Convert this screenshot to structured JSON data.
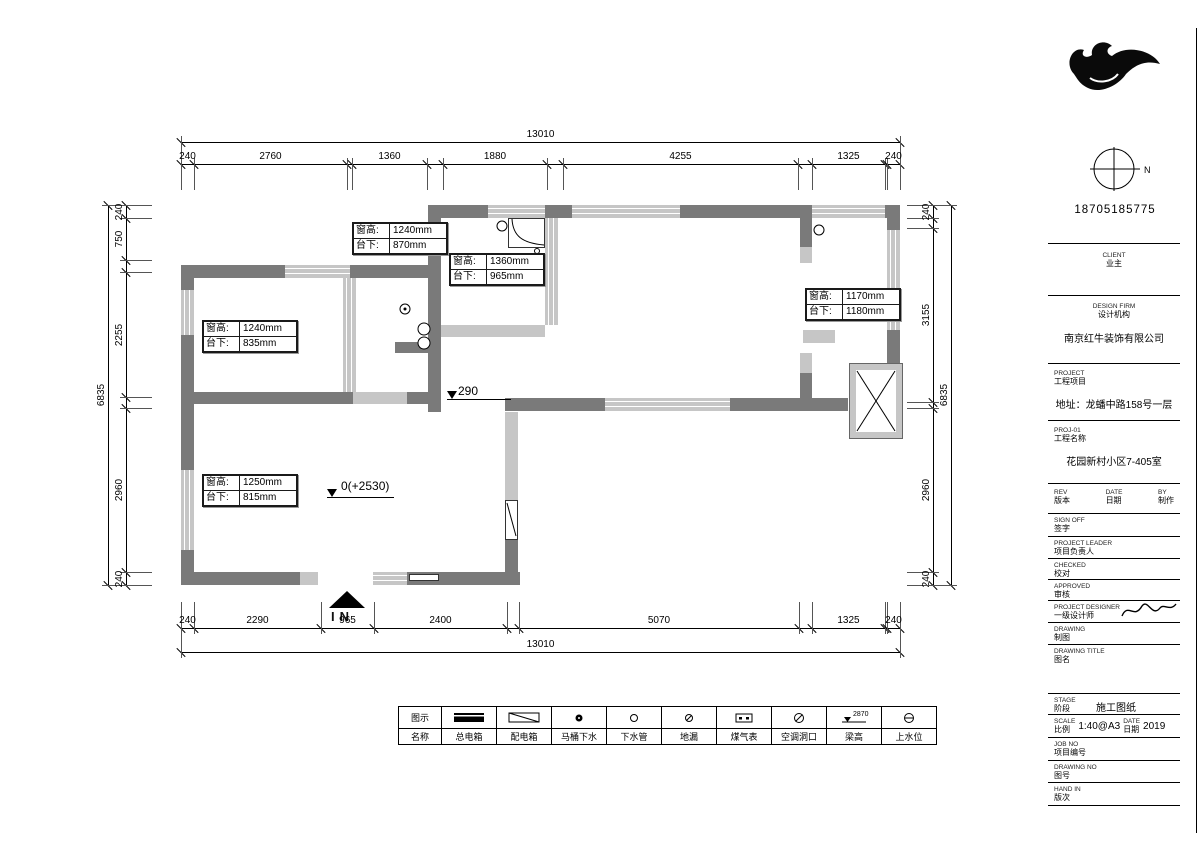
{
  "title_block": {
    "logo_text": "红牛装饰",
    "compass_label": "N",
    "phone": "18705185775",
    "rows": [
      {
        "y": 243,
        "type": "rule"
      },
      {
        "y": 252,
        "type": "center2",
        "en": "CLIENT",
        "zh": "业主"
      },
      {
        "y": 295,
        "type": "rule"
      },
      {
        "y": 303,
        "type": "center2",
        "en": "DESIGN FIRM",
        "zh": "设计机构"
      },
      {
        "y": 330,
        "type": "value",
        "text": "南京红牛装饰有限公司"
      },
      {
        "y": 363,
        "type": "rule"
      },
      {
        "y": 370,
        "type": "left2",
        "en": "PROJECT",
        "zh": "工程项目"
      },
      {
        "y": 396,
        "type": "value",
        "text": "地址：龙蟠中路158号一层"
      },
      {
        "y": 420,
        "type": "rule"
      },
      {
        "y": 427,
        "type": "left2",
        "en": "PROJ-01",
        "zh": "工程名称"
      },
      {
        "y": 453,
        "type": "value",
        "text": "花园新村小区7-405室"
      },
      {
        "y": 483,
        "type": "rule"
      },
      {
        "y": 489,
        "type": "cols3",
        "c1en": "REV",
        "c1zh": "版本",
        "c2en": "DATE",
        "c2zh": "日期",
        "c3en": "BY",
        "c3zh": "制作"
      },
      {
        "y": 513,
        "type": "rule"
      },
      {
        "y": 517,
        "type": "left2",
        "en": "SIGN OFF",
        "zh": "签字"
      },
      {
        "y": 536,
        "type": "rule"
      },
      {
        "y": 540,
        "type": "left2",
        "en": "PROJECT LEADER",
        "zh": "项目负责人"
      },
      {
        "y": 558,
        "type": "rule"
      },
      {
        "y": 562,
        "type": "left2",
        "en": "CHECKED",
        "zh": "校对"
      },
      {
        "y": 579,
        "type": "rule"
      },
      {
        "y": 583,
        "type": "left2",
        "en": "APPROVED",
        "zh": "审核"
      },
      {
        "y": 600,
        "type": "rule"
      },
      {
        "y": 604,
        "type": "left2sig",
        "en": "PROJECT DESIGNER",
        "zh": "一级设计师"
      },
      {
        "y": 622,
        "type": "rule"
      },
      {
        "y": 626,
        "type": "left2",
        "en": "DRAWING",
        "zh": "制图"
      },
      {
        "y": 644,
        "type": "rule"
      },
      {
        "y": 648,
        "type": "left2",
        "en": "DRAWING TITLE",
        "zh": "图名"
      },
      {
        "y": 693,
        "type": "rule"
      },
      {
        "y": 697,
        "type": "stage",
        "en": "STAGE",
        "zh": "阶段",
        "value": "施工图纸"
      },
      {
        "y": 714,
        "type": "rule"
      },
      {
        "y": 718,
        "type": "scaledate",
        "en1": "SCALE",
        "zh1": "比例",
        "v1": "1:40@A3",
        "en2": "DATE",
        "zh2": "日期",
        "v2": "2019"
      },
      {
        "y": 737,
        "type": "rule"
      },
      {
        "y": 741,
        "type": "left2",
        "en": "JOB NO",
        "zh": "项目编号"
      },
      {
        "y": 760,
        "type": "rule"
      },
      {
        "y": 764,
        "type": "left2",
        "en": "DRAWING NO",
        "zh": "图号"
      },
      {
        "y": 782,
        "type": "rule"
      },
      {
        "y": 786,
        "type": "left2",
        "en": "HAND IN",
        "zh": "版次"
      },
      {
        "y": 805,
        "type": "rule"
      }
    ]
  },
  "dimensions": {
    "chains": [
      {
        "id": "top-total",
        "orient": "h",
        "x": 181,
        "y": 142,
        "length": 719,
        "dir": "down",
        "segments": [
          {
            "from": 0,
            "to": 719,
            "label": "13010"
          }
        ]
      },
      {
        "id": "top-segments",
        "orient": "h",
        "x": 181,
        "y": 164,
        "length": 719,
        "dir": "down",
        "segments": [
          {
            "from": 0,
            "to": 13,
            "label": "240"
          },
          {
            "from": 13,
            "to": 166,
            "label": "2760"
          },
          {
            "from": 171,
            "to": 246,
            "label": "1360"
          },
          {
            "from": 262,
            "to": 366,
            "label": "1880"
          },
          {
            "from": 382,
            "to": 617,
            "label": "4255"
          },
          {
            "from": 631,
            "to": 704,
            "label": "1325"
          },
          {
            "from": 706,
            "to": 719,
            "label": "240"
          }
        ]
      },
      {
        "id": "bottom-segments",
        "orient": "h",
        "x": 181,
        "y": 628,
        "length": 719,
        "dir": "up",
        "segments": [
          {
            "from": 0,
            "to": 13,
            "label": "240"
          },
          {
            "from": 13,
            "to": 140,
            "label": "2290"
          },
          {
            "from": 140,
            "to": 193,
            "label": "965"
          },
          {
            "from": 193,
            "to": 326,
            "label": "2400"
          },
          {
            "from": 338,
            "to": 618,
            "label": "5070"
          },
          {
            "from": 631,
            "to": 704,
            "label": "1325"
          },
          {
            "from": 706,
            "to": 719,
            "label": "240"
          }
        ]
      },
      {
        "id": "bottom-total",
        "orient": "h",
        "x": 181,
        "y": 652,
        "length": 719,
        "dir": "up",
        "segments": [
          {
            "from": 0,
            "to": 719,
            "label": "13010"
          }
        ]
      },
      {
        "id": "left-total",
        "orient": "v",
        "x": 108,
        "y": 205,
        "length": 380,
        "dir": "right",
        "segments": [
          {
            "from": 0,
            "to": 380,
            "label": "6835"
          }
        ]
      },
      {
        "id": "left-segments",
        "orient": "v",
        "x": 126,
        "y": 205,
        "length": 380,
        "dir": "right",
        "segments": [
          {
            "from": 0,
            "to": 13,
            "label": "240"
          },
          {
            "from": 13,
            "to": 55,
            "label": "750"
          },
          {
            "from": 67,
            "to": 192,
            "label": "2255"
          },
          {
            "from": 203,
            "to": 367,
            "label": "2960"
          },
          {
            "from": 367,
            "to": 380,
            "label": "240"
          }
        ]
      },
      {
        "id": "right-segments",
        "orient": "v",
        "x": 933,
        "y": 205,
        "length": 380,
        "dir": "left",
        "segments": [
          {
            "from": 0,
            "to": 13,
            "label": "240"
          },
          {
            "from": 23,
            "to": 197,
            "label": "3155"
          },
          {
            "from": 203,
            "to": 367,
            "label": "2960"
          },
          {
            "from": 367,
            "to": 380,
            "label": "240"
          }
        ]
      },
      {
        "id": "right-total",
        "orient": "v",
        "x": 951,
        "y": 205,
        "length": 380,
        "dir": "left",
        "segments": [
          {
            "from": 0,
            "to": 380,
            "label": "6835"
          }
        ]
      }
    ]
  },
  "plan": {
    "window_labels": [
      {
        "x": 352,
        "y": 222,
        "rows": [
          [
            "窗高:",
            "1240mm"
          ],
          [
            "台下:",
            "870mm"
          ]
        ]
      },
      {
        "x": 449,
        "y": 253,
        "rows": [
          [
            "窗高:",
            "1360mm"
          ],
          [
            "台下:",
            "965mm"
          ]
        ]
      },
      {
        "x": 805,
        "y": 288,
        "rows": [
          [
            "窗高:",
            "1170mm"
          ],
          [
            "台下:",
            "1180mm"
          ]
        ]
      },
      {
        "x": 202,
        "y": 320,
        "rows": [
          [
            "窗高:",
            "1240mm"
          ],
          [
            "台下:",
            "835mm"
          ]
        ]
      },
      {
        "x": 202,
        "y": 474,
        "rows": [
          [
            "窗高:",
            "1250mm"
          ],
          [
            "台下:",
            "815mm"
          ]
        ]
      }
    ],
    "level_markers": [
      {
        "x": 458,
        "y": 384,
        "text": "290"
      },
      {
        "x": 341,
        "y": 479,
        "text": "0(+2530)"
      }
    ],
    "entry": {
      "label": "IN"
    }
  },
  "legend": {
    "col1": {
      "row1": "图示",
      "row2": "名称"
    },
    "items": [
      {
        "icon": "main-electric-box",
        "label": "总电箱"
      },
      {
        "icon": "distribution-box",
        "label": "配电箱"
      },
      {
        "icon": "toilet-drain",
        "label": "马桶下水"
      },
      {
        "icon": "drain-pipe",
        "label": "下水管"
      },
      {
        "icon": "floor-drain",
        "label": "地漏"
      },
      {
        "icon": "gas-meter",
        "label": "煤气表"
      },
      {
        "icon": "ac-opening",
        "label": "空调洞口"
      },
      {
        "icon": "beam-height",
        "label": "梁高",
        "value": "2870"
      },
      {
        "icon": "water-supply",
        "label": "上水位"
      }
    ]
  },
  "colors": {
    "wall_dark": "#7a7a7a",
    "window_light": "#c6c6c6",
    "line": "#000000"
  }
}
